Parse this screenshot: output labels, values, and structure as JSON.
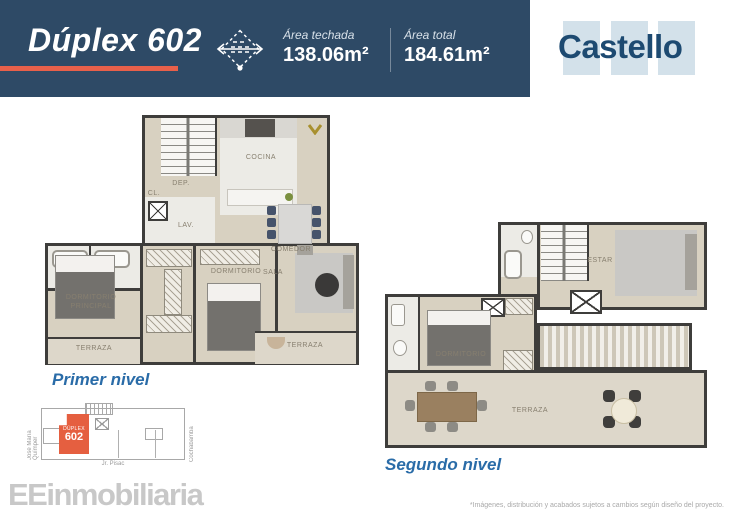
{
  "header": {
    "title": "Dúplex 602",
    "stats": [
      {
        "label": "Área techada",
        "value": "138.06m²"
      },
      {
        "label": "Área total",
        "value": "184.61m²"
      }
    ],
    "brand": "Castello",
    "area_icon": "dimension-diamond-icon"
  },
  "colors": {
    "header_navy": "#2e4a66",
    "accent_orange": "#e8604a",
    "brand_navy": "#1d4a71",
    "brand_block_blue": "#d3e1ea",
    "caption_blue": "#2a6ca8",
    "keyplan_orange": "#e55f40"
  },
  "plan_first": {
    "caption": "Primer nivel",
    "labels": {
      "cocina": "COCINA",
      "dep": "DEP.",
      "cl": "CL.",
      "lav": "LAV.",
      "comedor": "COMEDOR",
      "sala": "SALA",
      "dormitorio": "DORMITORIO",
      "dormitorio_principal": "DORMITORIO PRINCIPAL",
      "terraza_izq": "TERRAZA",
      "terraza_der": "TERRAZA"
    }
  },
  "plan_second": {
    "caption": "Segundo nivel",
    "labels": {
      "estar": "ESTAR",
      "dormitorio": "DORMITORIO",
      "terraza": "TERRAZA"
    }
  },
  "keyplan": {
    "unit_label": "DÚPLEX",
    "unit_number": "602",
    "street_left": "José María Químper",
    "street_right": "Cochabamba",
    "street_bottom": "Jr. Pisac"
  },
  "footer": {
    "brand_prefix": "EE",
    "brand_rest": "inmobiliaria",
    "disclaimer": "*Imágenes, distribución y acabados sujetos a cambios según diseño del proyecto."
  }
}
